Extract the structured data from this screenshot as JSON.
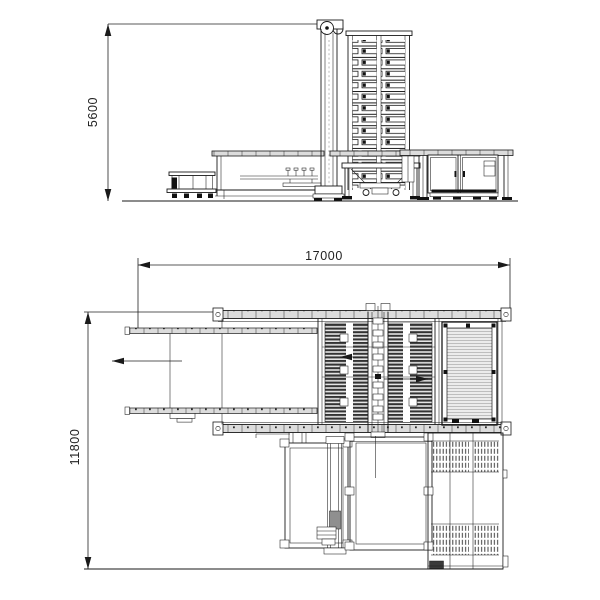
{
  "drawing": {
    "type": "engineering-cad-two-view-machine-layout",
    "elevation": {
      "height_dim": "5600"
    },
    "plan": {
      "length_dim": "17000",
      "width_dim": "11800"
    },
    "colors": {
      "line": "#1a1a1a",
      "dim": "#222222",
      "rail_fill": "#dcdcdc",
      "hatch_bg": "#ececec",
      "hatch_line": "#a0a0a0",
      "block_gray": "#8f8f8f",
      "black_fill": "#111111",
      "background": "#ffffff"
    }
  }
}
